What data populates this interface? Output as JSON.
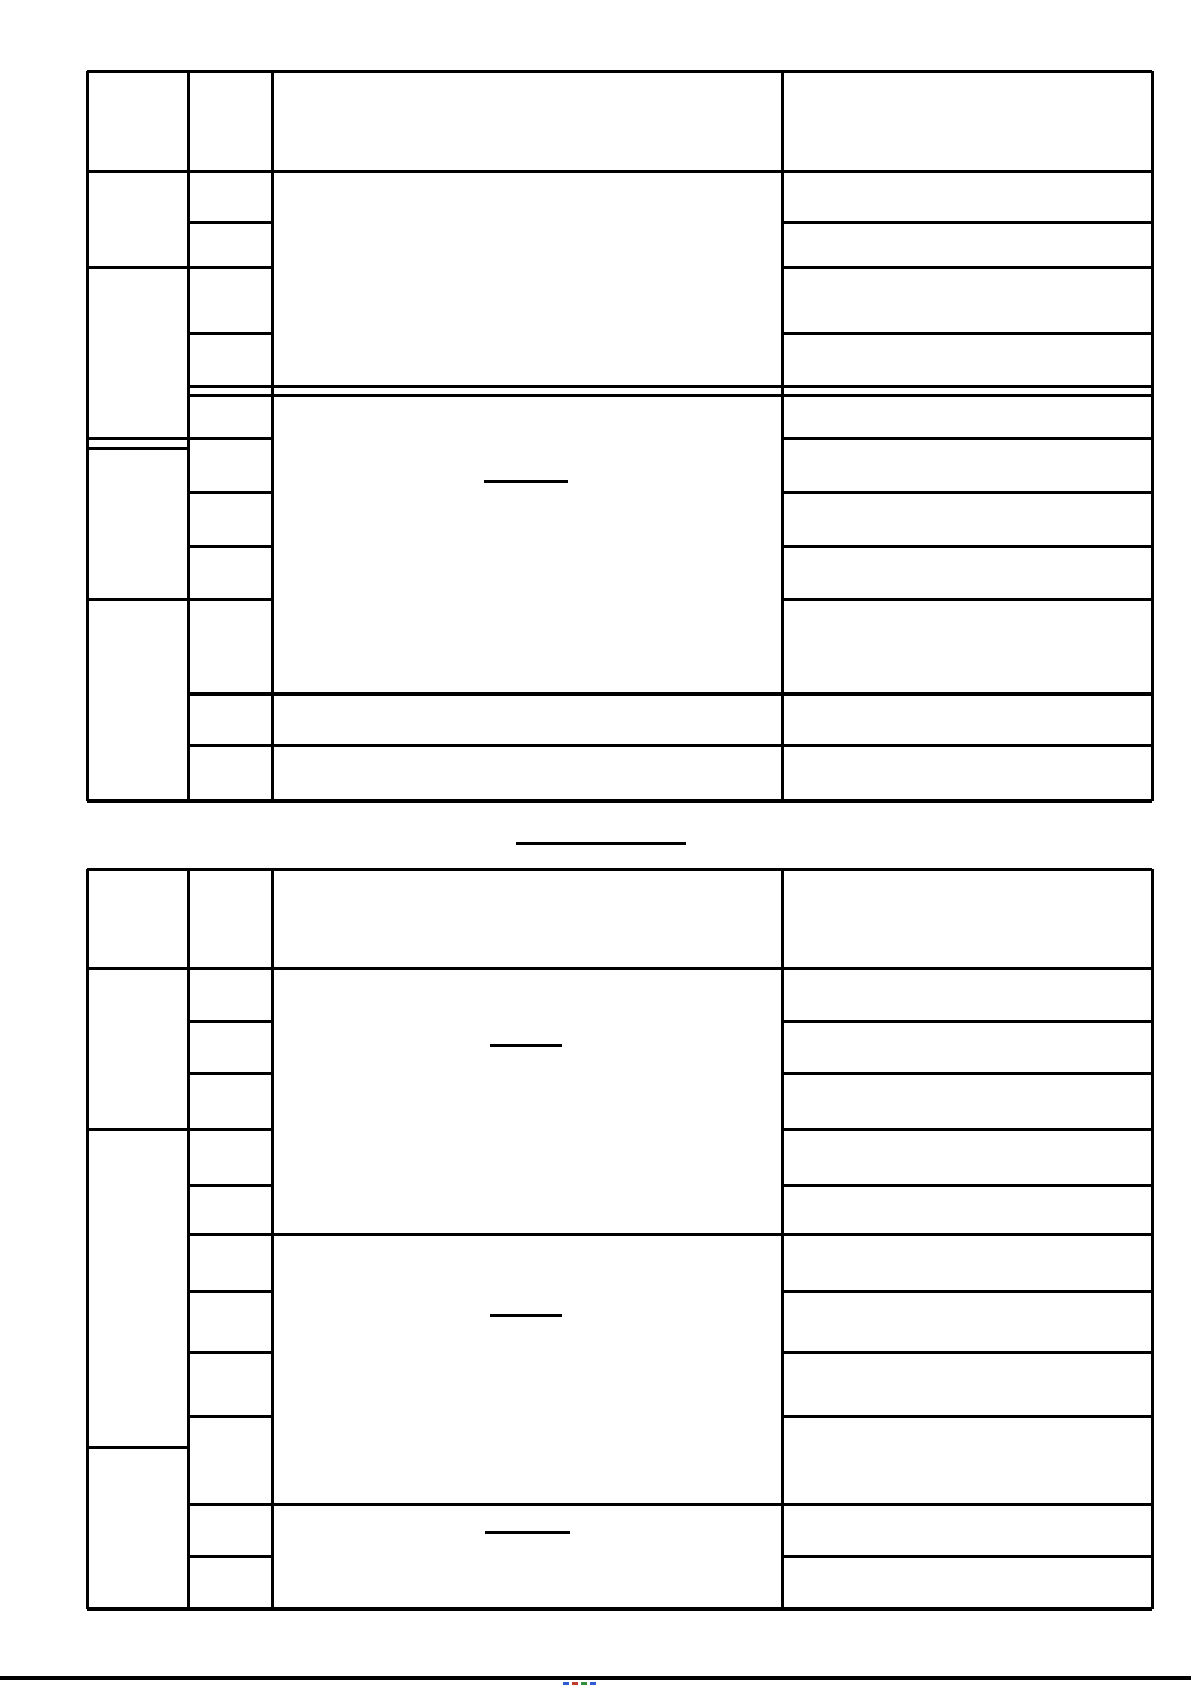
{
  "page": {
    "width": 1191,
    "height": 1685,
    "background_color": "#ffffff",
    "line_color": "#000000",
    "content_text": "",
    "description": "blank two-table form page, no visible text"
  },
  "tables": [
    {
      "name": "table-1",
      "left": 87,
      "right": 1152,
      "top": 71,
      "bottom": 801,
      "column_x": [
        87,
        188,
        272,
        782,
        1152
      ],
      "v_segments": [
        {
          "x": 87,
          "y1": 71,
          "y2": 801,
          "w": 3
        },
        {
          "x": 188,
          "y1": 71,
          "y2": 801,
          "w": 3
        },
        {
          "x": 272,
          "y1": 71,
          "y2": 801,
          "w": 3
        },
        {
          "x": 782,
          "y1": 71,
          "y2": 801,
          "w": 3
        },
        {
          "x": 1152,
          "y1": 71,
          "y2": 801,
          "w": 3
        }
      ],
      "h_segments": [
        {
          "y": 71,
          "x1": 87,
          "x2": 1152,
          "w": 3
        },
        {
          "y": 171,
          "x1": 87,
          "x2": 1152,
          "w": 3
        },
        {
          "y": 222,
          "x1": 188,
          "x2": 272,
          "w": 3
        },
        {
          "y": 222,
          "x1": 782,
          "x2": 1152,
          "w": 3
        },
        {
          "y": 267,
          "x1": 87,
          "x2": 272,
          "w": 3
        },
        {
          "y": 267,
          "x1": 782,
          "x2": 1152,
          "w": 3
        },
        {
          "y": 333,
          "x1": 188,
          "x2": 272,
          "w": 3
        },
        {
          "y": 333,
          "x1": 782,
          "x2": 1152,
          "w": 3
        },
        {
          "y": 386,
          "x1": 188,
          "x2": 1152,
          "w": 3
        },
        {
          "y": 395,
          "x1": 188,
          "x2": 1152,
          "w": 3
        },
        {
          "y": 438,
          "x1": 87,
          "x2": 272,
          "w": 3
        },
        {
          "y": 438,
          "x1": 782,
          "x2": 1152,
          "w": 3
        },
        {
          "y": 448,
          "x1": 87,
          "x2": 188,
          "w": 3
        },
        {
          "y": 492,
          "x1": 188,
          "x2": 272,
          "w": 3
        },
        {
          "y": 492,
          "x1": 782,
          "x2": 1152,
          "w": 3
        },
        {
          "y": 546,
          "x1": 188,
          "x2": 272,
          "w": 3
        },
        {
          "y": 546,
          "x1": 782,
          "x2": 1152,
          "w": 3
        },
        {
          "y": 599,
          "x1": 87,
          "x2": 272,
          "w": 3
        },
        {
          "y": 599,
          "x1": 782,
          "x2": 1152,
          "w": 3
        },
        {
          "y": 694,
          "x1": 188,
          "x2": 1152,
          "w": 4
        },
        {
          "y": 745,
          "x1": 188,
          "x2": 1152,
          "w": 3
        },
        {
          "y": 801,
          "x1": 87,
          "x2": 1152,
          "w": 4
        }
      ],
      "blank_underlines": [
        {
          "x1": 484,
          "x2": 568,
          "y": 481,
          "w": 3
        }
      ]
    },
    {
      "name": "table-2",
      "left": 87,
      "right": 1152,
      "top": 869,
      "bottom": 1609,
      "column_x": [
        87,
        188,
        272,
        782,
        1152
      ],
      "v_segments": [
        {
          "x": 87,
          "y1": 869,
          "y2": 1609,
          "w": 3
        },
        {
          "x": 188,
          "y1": 869,
          "y2": 1609,
          "w": 3
        },
        {
          "x": 272,
          "y1": 869,
          "y2": 1609,
          "w": 3
        },
        {
          "x": 782,
          "y1": 869,
          "y2": 1609,
          "w": 3
        },
        {
          "x": 1152,
          "y1": 869,
          "y2": 1609,
          "w": 3
        }
      ],
      "h_segments": [
        {
          "y": 869,
          "x1": 87,
          "x2": 1152,
          "w": 3
        },
        {
          "y": 968,
          "x1": 87,
          "x2": 1152,
          "w": 3
        },
        {
          "y": 1021,
          "x1": 188,
          "x2": 272,
          "w": 3
        },
        {
          "y": 1021,
          "x1": 782,
          "x2": 1152,
          "w": 3
        },
        {
          "y": 1073,
          "x1": 188,
          "x2": 272,
          "w": 3
        },
        {
          "y": 1073,
          "x1": 782,
          "x2": 1152,
          "w": 3
        },
        {
          "y": 1129,
          "x1": 87,
          "x2": 272,
          "w": 3
        },
        {
          "y": 1129,
          "x1": 782,
          "x2": 1152,
          "w": 3
        },
        {
          "y": 1185,
          "x1": 188,
          "x2": 272,
          "w": 3
        },
        {
          "y": 1185,
          "x1": 782,
          "x2": 1152,
          "w": 3
        },
        {
          "y": 1234,
          "x1": 188,
          "x2": 1152,
          "w": 3
        },
        {
          "y": 1291,
          "x1": 188,
          "x2": 272,
          "w": 3
        },
        {
          "y": 1291,
          "x1": 782,
          "x2": 1152,
          "w": 3
        },
        {
          "y": 1352,
          "x1": 188,
          "x2": 272,
          "w": 3
        },
        {
          "y": 1352,
          "x1": 782,
          "x2": 1152,
          "w": 3
        },
        {
          "y": 1416,
          "x1": 188,
          "x2": 272,
          "w": 3
        },
        {
          "y": 1416,
          "x1": 782,
          "x2": 1152,
          "w": 3
        },
        {
          "y": 1447,
          "x1": 87,
          "x2": 188,
          "w": 3
        },
        {
          "y": 1504,
          "x1": 188,
          "x2": 1152,
          "w": 3
        },
        {
          "y": 1556,
          "x1": 188,
          "x2": 272,
          "w": 3
        },
        {
          "y": 1556,
          "x1": 782,
          "x2": 1152,
          "w": 3
        },
        {
          "y": 1609,
          "x1": 87,
          "x2": 1152,
          "w": 4
        }
      ],
      "blank_underlines": [
        {
          "x1": 490,
          "x2": 562,
          "y": 1045,
          "w": 3
        },
        {
          "x1": 490,
          "x2": 562,
          "y": 1315,
          "w": 3
        },
        {
          "x1": 485,
          "x2": 570,
          "y": 1532,
          "w": 3
        }
      ]
    }
  ],
  "between_tables": {
    "blank_underline": {
      "x1": 516,
      "x2": 686,
      "y": 843,
      "w": 3
    }
  },
  "footer": {
    "rule": {
      "x1": 0,
      "x2": 1191,
      "y": 1678,
      "w": 4
    },
    "clipped_marks": [
      {
        "x": 563,
        "y": 1682,
        "w": 6,
        "h": 3,
        "color": "#2f5bd4"
      },
      {
        "x": 572,
        "y": 1682,
        "w": 6,
        "h": 3,
        "color": "#c23b2f"
      },
      {
        "x": 581,
        "y": 1682,
        "w": 6,
        "h": 3,
        "color": "#2f8f3c"
      },
      {
        "x": 590,
        "y": 1682,
        "w": 6,
        "h": 3,
        "color": "#2f5bd4"
      }
    ]
  }
}
